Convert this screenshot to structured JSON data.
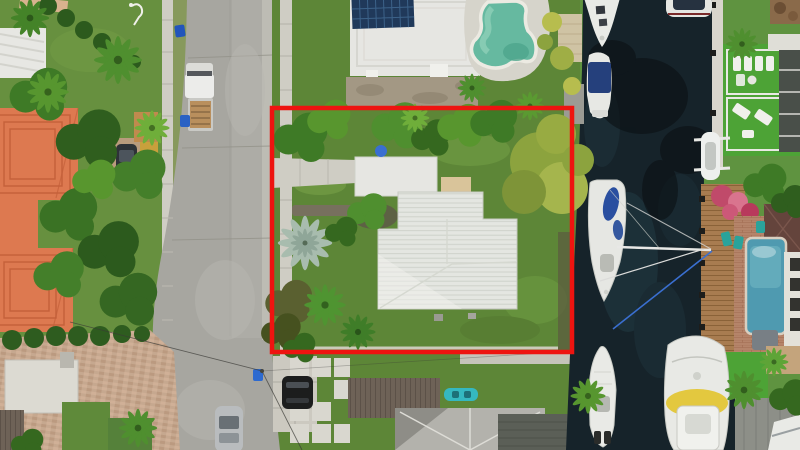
{
  "scene": {
    "type": "aerial-photograph",
    "setting": "Top-down drone photo of a waterfront residential lot, street to the west, boat canal to the east",
    "overlay": "red property-boundary outline around the subject lot"
  },
  "palette": {
    "boundary_red": "#ee1410",
    "water": "#16232a",
    "asphalt": "#a7a6a0",
    "concrete": "#cfcdc4",
    "lawn_west": "#67903f",
    "lawn_lot": "#5d8637",
    "lawn_east": "#5f9340",
    "turf_east": "#4da336",
    "white_roof": "#e6e6e2",
    "orange_roof": "#dd7950",
    "solar_panel": "#20395a",
    "pool_north": "#66b9a0",
    "pool_east": "#4f9ab0",
    "dock_wood": "#a87c50",
    "paver": "#c6a88f",
    "brick_patio": "#b5846a",
    "kayak_teal": "#35b8c0"
  },
  "landmarks": {
    "subject_lot": "Subject lot outlined in red with white metal-roof house and detached garage",
    "street": "Residential street with parked pickup truck and passing sedan",
    "canal": "Dark-water canal with moored boats",
    "north_pool": "Kidney-shaped pool beside solar-panel roof house",
    "east_pool": "Rectangular blue pool on east bank patio",
    "sailboat": "Sailboat moored along west seawall with rigging lines",
    "boats": "Bow yacht, blue-canopy cruiser, boat on lift, center-console boat, trawler yacht",
    "orange_house": "Terracotta-roof house west of street",
    "east_patio": "Turf patio with white loungers and dock on east bank"
  }
}
